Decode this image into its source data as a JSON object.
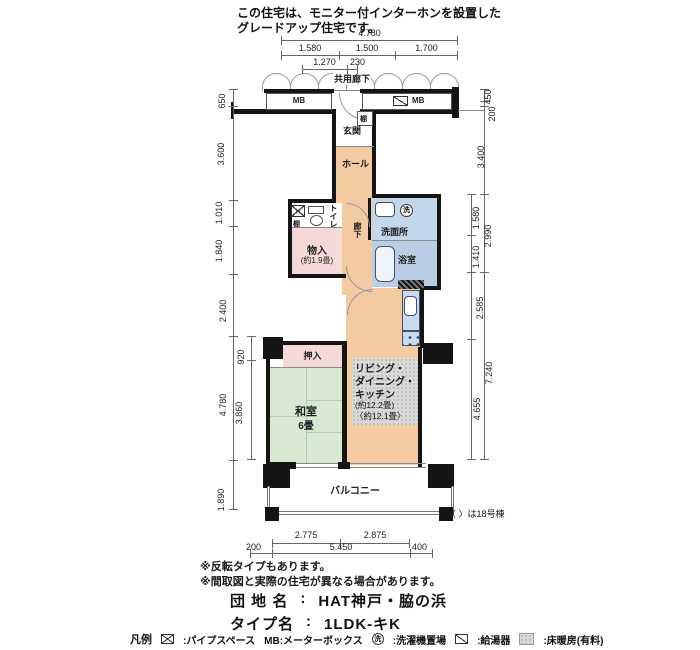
{
  "header": {
    "line1": "この住宅は、モニター付インターホンを設置した",
    "line2": "グレードアップ住宅です。"
  },
  "plan": {
    "corridor_label": "共用廊下",
    "mb_left": "MB",
    "mb_right": "MB",
    "shelf_top": "棚",
    "entrance": "玄関",
    "hall": "ホール",
    "toilet": "トイレ",
    "shelf_toilet": "棚",
    "storage": "物入",
    "storage_size": "(約1.9畳)",
    "hallway": "廊下",
    "washroom": "洗面所",
    "laundry_mark": "洗",
    "bathroom": "浴室",
    "ldk_line1": "リビング・",
    "ldk_line2": "ダイニング・",
    "ldk_line3": "キッチン",
    "ldk_size1": "(約12.2畳)",
    "ldk_size2": "〈約12.1畳〉",
    "closet": "押入",
    "tatami_room": "和室",
    "tatami_size": "6畳",
    "balcony": "バルコニー",
    "bldg_note": "〈 〉は18号棟"
  },
  "dims": {
    "top_total": "4.780",
    "top_row2": [
      "1.580",
      "1.500",
      "1.700"
    ],
    "top_row3_a": "1.270",
    "top_row3_b": "230",
    "left": [
      "650",
      "3.600",
      "1.010",
      "1.840",
      "2.400",
      "4.780",
      "1.890"
    ],
    "left_inner": [
      "920",
      "3.860"
    ],
    "right": [
      "450",
      "200",
      "3.400",
      "2.990",
      "2.585",
      "7.240"
    ],
    "right_inner": [
      "1.580",
      "1.410",
      "4.655"
    ],
    "bottom_row1": [
      "2.775",
      "2.875"
    ],
    "bottom_row2": [
      "200",
      "5.450",
      "400"
    ]
  },
  "footer": {
    "note1": "※反転タイプもあります。",
    "note2": "※間取図と実際の住宅が異なる場合があります。",
    "estate_label": "団 地 名",
    "estate_sep": ":",
    "estate_value": "HAT神戸・脇の浜",
    "type_label": "タイプ名",
    "type_sep": ":",
    "type_value": "1LDK-キK"
  },
  "legend": {
    "title": "凡例",
    "pipe_space": ":パイプスペース",
    "mb": "MB:メーターボックス",
    "laundry_icon_char": "洗",
    "laundry": ":洗濯機置場",
    "heater": ":給湯器",
    "floor_heating": ":床暖房(有料)"
  },
  "colors": {
    "flooring_peach": "#f3caa2",
    "closet_pink": "#f5d9d8",
    "tatami_green": "#d7e9d1",
    "washroom_blue": "#c3d7ea",
    "bath_blue": "#b9cee4",
    "floor_heat_gray": "#dadada",
    "wall_black": "#151515"
  }
}
